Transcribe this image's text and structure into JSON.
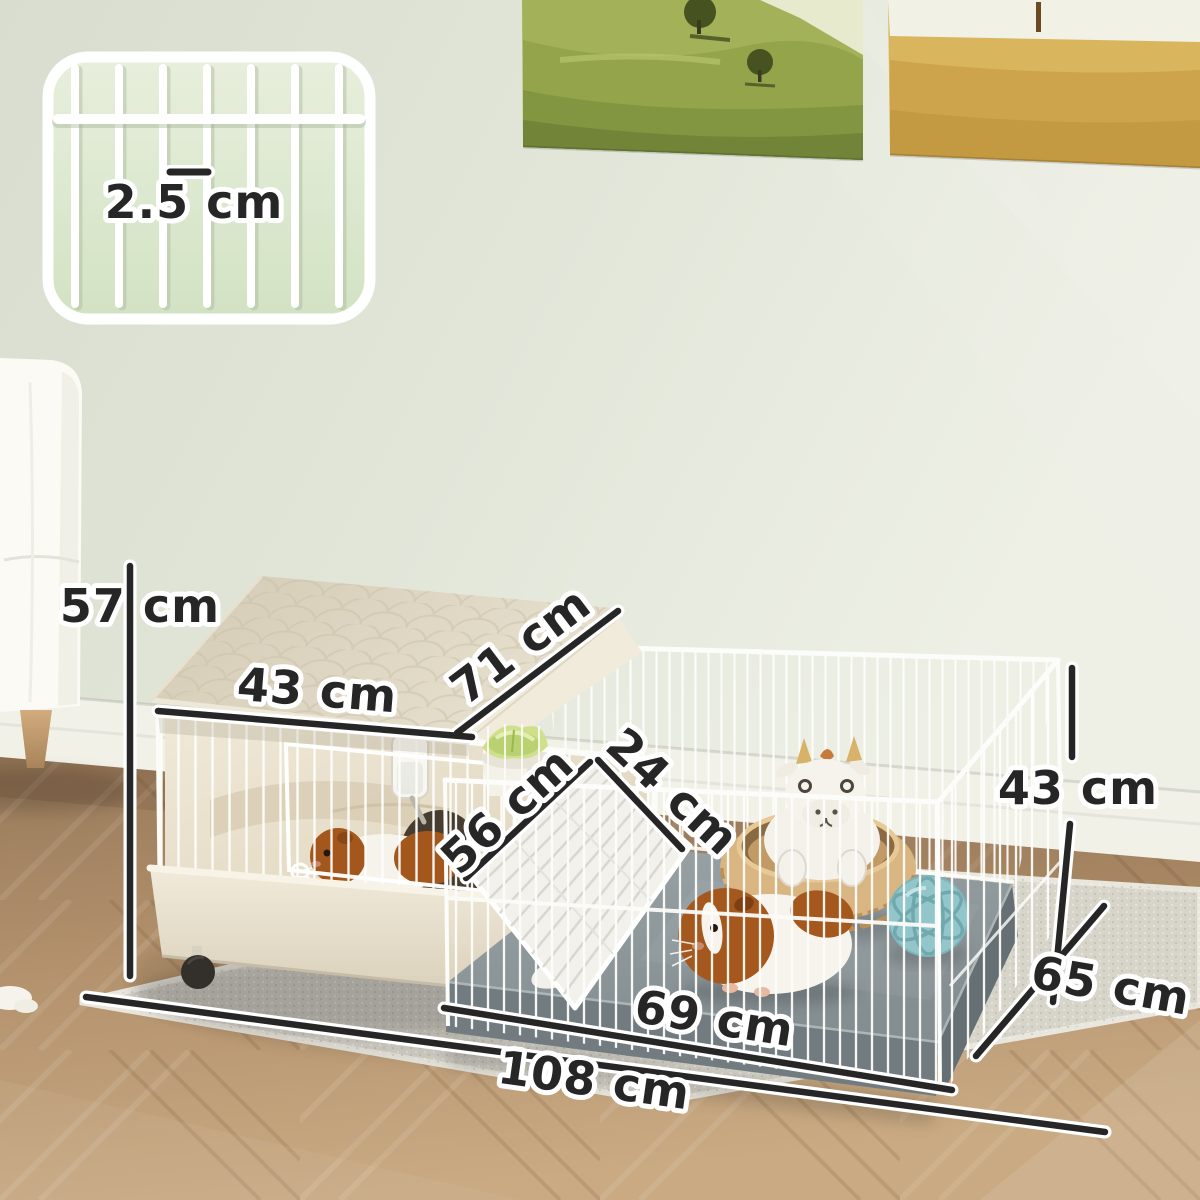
{
  "inset": {
    "label": "2.5 cm"
  },
  "dims": {
    "overall_height": "57 cm",
    "roof_width": "43 cm",
    "roof_slope_depth": "71 cm",
    "ramp_length": "56 cm",
    "ramp_width": "24 cm",
    "pen_height": "43 cm",
    "pen_depth": "65 cm",
    "pen_front_width": "69 cm",
    "overall_width": "108 cm"
  },
  "colors": {
    "annotation_ink": "#262626",
    "annotation_outline": "#ffffff",
    "wall": "#e1e5d8",
    "baseboard": "#f1f0e7",
    "wood_floor": "#b5946f",
    "rug": "#d7d4ca",
    "cage_wire": "#fcfcfa",
    "roof_beige": "#dcd4c0",
    "tray_beige": "#ece4d0",
    "pan_gray": "#8d979a",
    "inset_background": "#dde9d0",
    "cabbage_green": "#c3d787",
    "basket_tan": "#d7b27c",
    "ball_teal": "#93c6ca",
    "guinea_pig_brown": "#a4581d"
  }
}
